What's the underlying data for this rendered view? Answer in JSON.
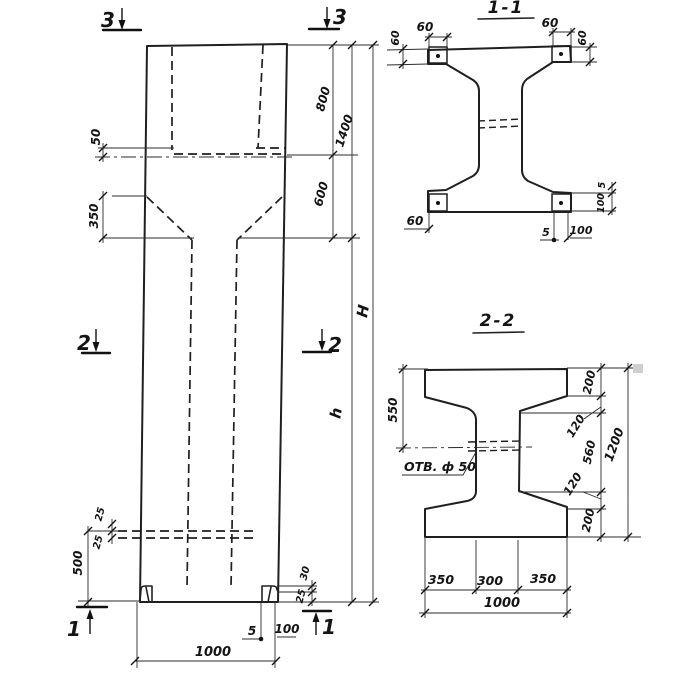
{
  "elevation": {
    "marks": {
      "top_left": "3",
      "top_right": "3",
      "mid_left": "2",
      "mid_right": "2",
      "bottom_left": "1",
      "bottom_right": "1"
    },
    "dims": {
      "lug50": "50",
      "taper350": "350",
      "seg800": "800",
      "total1400": "1400",
      "seg600": "600",
      "H": "H",
      "h": "h",
      "hole25a": "25",
      "hole25b": "25",
      "base500": "500",
      "foot30": "30",
      "foot25": "25",
      "foot5": "5",
      "foot100": "100",
      "width1000": "1000"
    }
  },
  "section11": {
    "title": "1-1",
    "dims": {
      "tl60": "60",
      "tr60": "60",
      "left60": "60",
      "right60": "60",
      "bl60": "60",
      "plate5": "5",
      "plate100": "100",
      "bot5": "5",
      "bot100": "100"
    }
  },
  "section22": {
    "title": "2-2",
    "hole_label": "ОТВ. ф 50",
    "dims": {
      "left550": "550",
      "r200t": "200",
      "r120t": "120",
      "r560": "560",
      "r120b": "120",
      "r200b": "200",
      "r1200": "1200",
      "b350l": "350",
      "b300": "300",
      "b350r": "350",
      "b1000": "1000"
    }
  }
}
